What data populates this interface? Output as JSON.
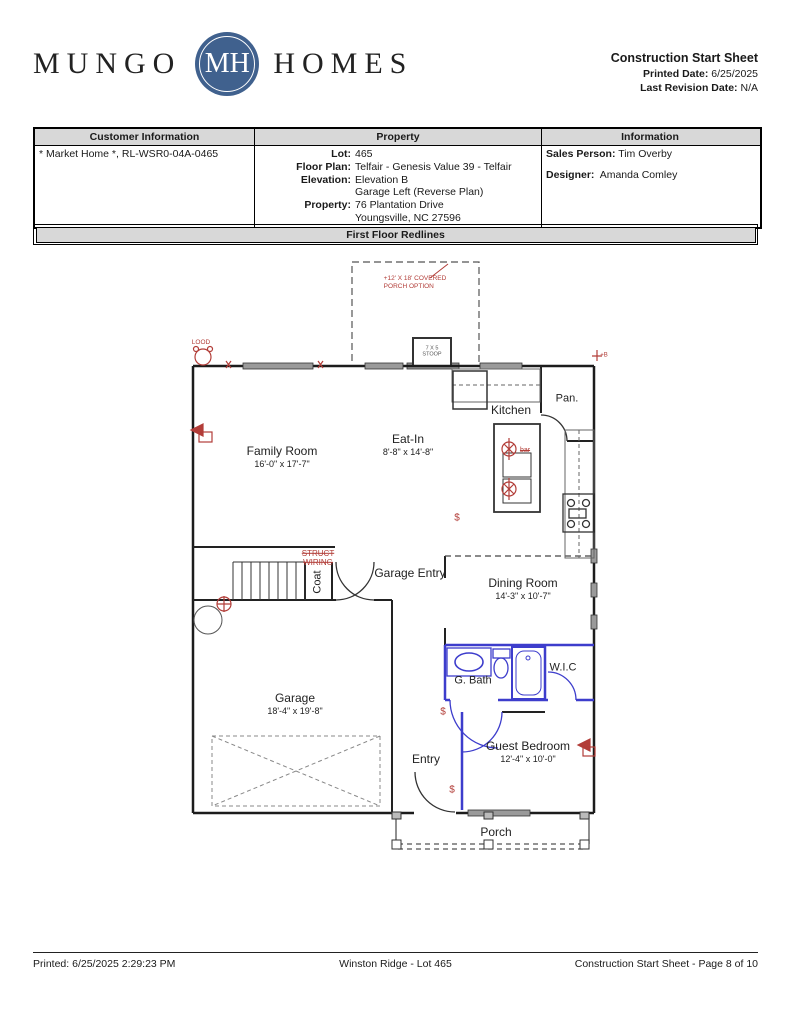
{
  "header": {
    "logo": {
      "word_left": "MUNGO",
      "monogram": "MH",
      "word_right": "HOMES"
    },
    "doc_title": "Construction Start Sheet",
    "printed_label": "Printed Date:",
    "printed_value": "6/25/2025",
    "revision_label": "Last Revision Date:",
    "revision_value": "N/A"
  },
  "info_table": {
    "headers": [
      "Customer Information",
      "Property",
      "Information"
    ],
    "customer_value": "* Market Home *, RL-WSR0-04A-0465",
    "property_rows": [
      {
        "label": "Lot:",
        "value": "465"
      },
      {
        "label": "Floor Plan:",
        "value": "Telfair - Genesis Value 39 - Telfair"
      },
      {
        "label": "Elevation:",
        "value": "Elevation B"
      },
      {
        "label": "",
        "value": "Garage Left (Reverse Plan)"
      },
      {
        "label": "Property:",
        "value": "76 Plantation Drive"
      },
      {
        "label": "",
        "value": "Youngsville, NC 27596"
      }
    ],
    "information_rows": [
      {
        "label": "Sales Person:",
        "value": "Tim Overby"
      },
      {
        "label": "Designer:",
        "value": "Amanda Comley"
      }
    ]
  },
  "section_title": "First Floor Redlines",
  "floorplan": {
    "rooms": [
      {
        "name": "Family Room",
        "dims": "16'-0\" x 17'-7\""
      },
      {
        "name": "Eat-In",
        "dims": "8'-8\" x 14'-8\""
      },
      {
        "name": "Kitchen",
        "dims": ""
      },
      {
        "name": "Pan.",
        "dims": ""
      },
      {
        "name": "Garage Entry",
        "dims": ""
      },
      {
        "name": "Dining Room",
        "dims": "14'-3\" x 10'-7\""
      },
      {
        "name": "Coat",
        "dims": ""
      },
      {
        "name": "G. Bath",
        "dims": ""
      },
      {
        "name": "W.I.C",
        "dims": ""
      },
      {
        "name": "Garage",
        "dims": "18'-4\" x 19'-8\""
      },
      {
        "name": "Entry",
        "dims": ""
      },
      {
        "name": "Guest Bedroom",
        "dims": "12'-4\" x 10'-0\""
      },
      {
        "name": "Porch",
        "dims": ""
      }
    ],
    "porch_option_line1": "+12' X 18' COVERED",
    "porch_option_line2": "PORCH OPTION",
    "stoop_line1": "7 X 5",
    "stoop_line2": "STOOP",
    "red_notes": {
      "flood_label": "LOOD",
      "struct_line1": "STRUCT",
      "struct_line2": "WIRING",
      "bar_label": "bar",
      "hose_bib": "+B",
      "switch_symbol": "$"
    }
  },
  "footer": {
    "left": "Printed: 6/25/2025 2:29:23 PM",
    "center": "Winston Ridge - Lot 465",
    "right": "Construction Start Sheet - Page 8 of 10"
  },
  "colors": {
    "redline": "#b23d38",
    "blueline": "#3d3dcc",
    "logo_blue": "#40618e",
    "table_header_gray": "#d8d8d8"
  }
}
